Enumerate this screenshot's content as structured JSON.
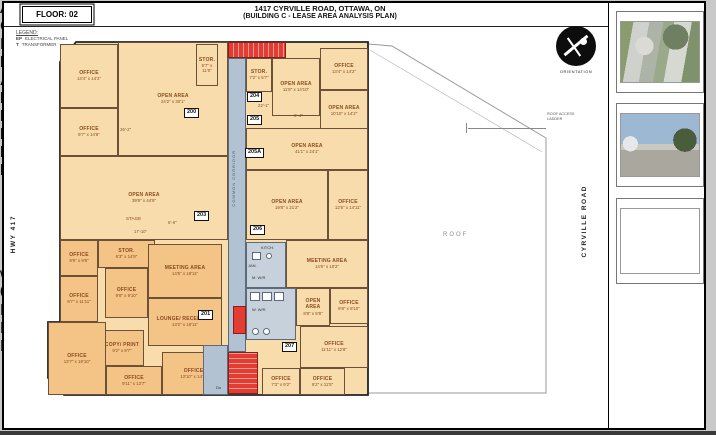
{
  "header": {
    "floor_badge": "FLOOR: 02",
    "title_line1": "1417 CYRVILLE ROAD, OTTAWA, ON",
    "title_line2": "(BUILDING C - LEASE AREA ANALYSIS PLAN)"
  },
  "legend": {
    "title": "LEGEND:",
    "items": [
      {
        "abbr": "EP",
        "label": "ELECTRICAL PANEL"
      },
      {
        "abbr": "T",
        "label": "TRANSFORMER"
      }
    ]
  },
  "roads": {
    "left": "HWY 417",
    "right": "CYRVILLE ROAD"
  },
  "orientation_label": "ORIENTATION",
  "roof": {
    "label": "ROOF",
    "annotation": "ROOF ACCESS LADDER"
  },
  "corridor_label": "COMMON CORRIDOR",
  "stage": {
    "label": "STAGE",
    "dim": "17'-10\""
  },
  "plan": {
    "rooms": [
      {
        "name": "OFFICE",
        "dims": "14'4\" x 14'2\"",
        "x": 60,
        "y": 44,
        "w": 58,
        "h": 64,
        "tone": "light"
      },
      {
        "name": "OFFICE",
        "dims": "9'7\" x 14'8\"",
        "x": 60,
        "y": 108,
        "w": 58,
        "h": 48,
        "tone": "light"
      },
      {
        "name": "OPEN AREA",
        "dims": "24'2\" x 30'1\"",
        "x": 118,
        "y": 42,
        "w": 110,
        "h": 114,
        "tone": "light"
      },
      {
        "name": "STOR.",
        "dims": "5'7\" x 11'0\"",
        "x": 196,
        "y": 44,
        "w": 22,
        "h": 42,
        "tone": "light"
      },
      {
        "name": "OPEN AREA",
        "dims": "39'9\" x 44'9\"",
        "x": 60,
        "y": 156,
        "w": 168,
        "h": 84,
        "tone": "light"
      },
      {
        "name": "OFFICE",
        "dims": "9'9\" x 9'8\"",
        "x": 60,
        "y": 240,
        "w": 38,
        "h": 36,
        "tone": "mid"
      },
      {
        "name": "OFFICE",
        "dims": "9'7\" x 11'11\"",
        "x": 60,
        "y": 276,
        "w": 38,
        "h": 46,
        "tone": "mid"
      },
      {
        "name": "STOR.",
        "dims": "6'3\" x 14'8\"",
        "x": 98,
        "y": 240,
        "w": 57,
        "h": 28,
        "tone": "mid"
      },
      {
        "name": "OFFICE",
        "dims": "9'8\" x 9'10\"",
        "x": 105,
        "y": 268,
        "w": 43,
        "h": 50,
        "tone": "mid"
      },
      {
        "name": "MEETING AREA",
        "dims": "14'5\" x 19'11\"",
        "x": 148,
        "y": 244,
        "w": 74,
        "h": 54,
        "tone": "mid"
      },
      {
        "name": "LOUNGE/ RECEPTION",
        "dims": "13'2\" x 19'11\"",
        "x": 148,
        "y": 298,
        "w": 74,
        "h": 48,
        "tone": "mid"
      },
      {
        "name": "COPY/ PRINT",
        "dims": "9'2\" x 9'7\"",
        "x": 100,
        "y": 330,
        "w": 44,
        "h": 36,
        "tone": "mid"
      },
      {
        "name": "OFFICE",
        "dims": "13'7\" x 19'10\"",
        "x": 48,
        "y": 322,
        "w": 58,
        "h": 73,
        "tone": "mid"
      },
      {
        "name": "OFFICE",
        "dims": "9'11\" x 13'7\"",
        "x": 106,
        "y": 366,
        "w": 56,
        "h": 29,
        "tone": "mid"
      },
      {
        "name": "OFFICE",
        "dims": "13'10\" x 14'8\"",
        "x": 162,
        "y": 352,
        "w": 63,
        "h": 43,
        "tone": "mid"
      },
      {
        "name": "STOR.",
        "dims": "7'2\" x 5'7\"",
        "x": 246,
        "y": 58,
        "w": 26,
        "h": 34,
        "tone": "light"
      },
      {
        "name": "OPEN AREA",
        "dims": "11'8\" x 14'10\"",
        "x": 272,
        "y": 58,
        "w": 48,
        "h": 58,
        "tone": "light"
      },
      {
        "name": "OFFICE",
        "dims": "13'4\" x 14'2\"",
        "x": 320,
        "y": 48,
        "w": 48,
        "h": 42,
        "tone": "light"
      },
      {
        "name": "OPEN AREA",
        "dims": "10'10\" x 14'2\"",
        "x": 320,
        "y": 90,
        "w": 48,
        "h": 42,
        "tone": "light"
      },
      {
        "name": "OPEN AREA",
        "dims": "41'1\" x 24'1\"",
        "x": 246,
        "y": 128,
        "w": 122,
        "h": 42,
        "tone": "light"
      },
      {
        "name": "OPEN AREA",
        "dims": "19'8\" x 21'2\"",
        "x": 246,
        "y": 170,
        "w": 82,
        "h": 70,
        "tone": "light"
      },
      {
        "name": "OFFICE",
        "dims": "12'6\" x 14'11\"",
        "x": 328,
        "y": 170,
        "w": 40,
        "h": 70,
        "tone": "light"
      },
      {
        "name": "MEETING AREA",
        "dims": "14'5\" x 10'2\"",
        "x": 286,
        "y": 240,
        "w": 82,
        "h": 48,
        "tone": "light"
      },
      {
        "name": "OPEN AREA",
        "dims": "8'8\" x 9'8\"",
        "x": 296,
        "y": 288,
        "w": 34,
        "h": 38,
        "tone": "light"
      },
      {
        "name": "OFFICE",
        "dims": "9'8\" x 8'10\"",
        "x": 330,
        "y": 288,
        "w": 38,
        "h": 36,
        "tone": "light"
      },
      {
        "name": "OFFICE",
        "dims": "11'11\" x 12'8\"",
        "x": 300,
        "y": 326,
        "w": 68,
        "h": 42,
        "tone": "light"
      },
      {
        "name": "OFFICE",
        "dims": "7'3\" x 9'2\"",
        "x": 262,
        "y": 368,
        "w": 38,
        "h": 27,
        "tone": "light"
      },
      {
        "name": "OFFICE",
        "dims": "9'2\" x 11'5\"",
        "x": 300,
        "y": 368,
        "w": 45,
        "h": 27,
        "tone": "light"
      }
    ],
    "tags": [
      {
        "text": "200",
        "x": 184,
        "y": 108
      },
      {
        "text": "201",
        "x": 198,
        "y": 310
      },
      {
        "text": "203",
        "x": 194,
        "y": 211
      },
      {
        "text": "204",
        "x": 247,
        "y": 92
      },
      {
        "text": "205",
        "x": 247,
        "y": 115
      },
      {
        "text": "205A",
        "x": 245,
        "y": 148
      },
      {
        "text": "206",
        "x": 250,
        "y": 225
      },
      {
        "text": "207",
        "x": 282,
        "y": 342
      }
    ],
    "dim_labels": [
      {
        "text": "22'-1\"",
        "x": 258,
        "y": 104
      },
      {
        "text": "6'-4\"",
        "x": 294,
        "y": 114
      },
      {
        "text": "6'-6\"",
        "x": 168,
        "y": 221
      },
      {
        "text": "36'-2\"",
        "x": 120,
        "y": 128
      }
    ],
    "small_labels": [
      {
        "text": "KITCH.",
        "x": 261,
        "y": 246
      },
      {
        "text": "JAN.",
        "x": 248,
        "y": 264
      },
      {
        "text": "M. W/R",
        "x": 252,
        "y": 276
      },
      {
        "text": "W. W/R",
        "x": 252,
        "y": 308
      },
      {
        "text": "Dn",
        "x": 216,
        "y": 386
      }
    ]
  },
  "sidebar": {
    "photos": [
      {
        "caption": "AERIAL VIEW",
        "kind": "aerial"
      },
      {
        "caption": "CYRVILLE RD. VIEW",
        "kind": "street"
      },
      {
        "caption": "HWY 417 VIEW",
        "kind": "highway"
      }
    ],
    "titleblock": [
      {
        "label": "PREPARED FOR:",
        "value": "District Realty Corporation, Brokerage"
      },
      {
        "label": "ADDRESS:",
        "value": "1417-C Cyrville Rd., Ottawa, ON"
      },
      {
        "label": "DATE:",
        "value": "October 15, 2010"
      },
      {
        "label": "REVISION:",
        "value": "n/a"
      },
      {
        "label": "PROJECT NUMBER:",
        "value": "100064"
      },
      {
        "label": "DRAWING SIZE:",
        "value": "8.5\" x 14\" - Legal Size"
      }
    ]
  },
  "scalebar": {
    "feet_ticks": [
      "0",
      "5",
      "10",
      "15",
      "20",
      "25"
    ],
    "feet_label": "FEET",
    "metre_ticks": [
      "0",
      "1.52",
      "3.05",
      "4.57",
      "6.10",
      "7.62"
    ],
    "metres_label": "METRES",
    "prepared_by_prefix": "PREPARED BY: ",
    "prepared_by_brand": "ECHO",
    "prepared_by_suffix": "FLOORPLANS.COM"
  },
  "logo": {
    "brand": "ECHO",
    "name_rest": " FLOOR PLANS",
    "bullets": [
      "As-Built Floor Plans",
      "Area Analysis",
      "Space Planning"
    ],
    "website": "www.ECHOFloorPlans.com"
  },
  "colors": {
    "room_light": "#f8dcab",
    "room_mid": "#f4c386",
    "common_blue": "#b3c2d2",
    "stair_red": "#e23c33"
  }
}
